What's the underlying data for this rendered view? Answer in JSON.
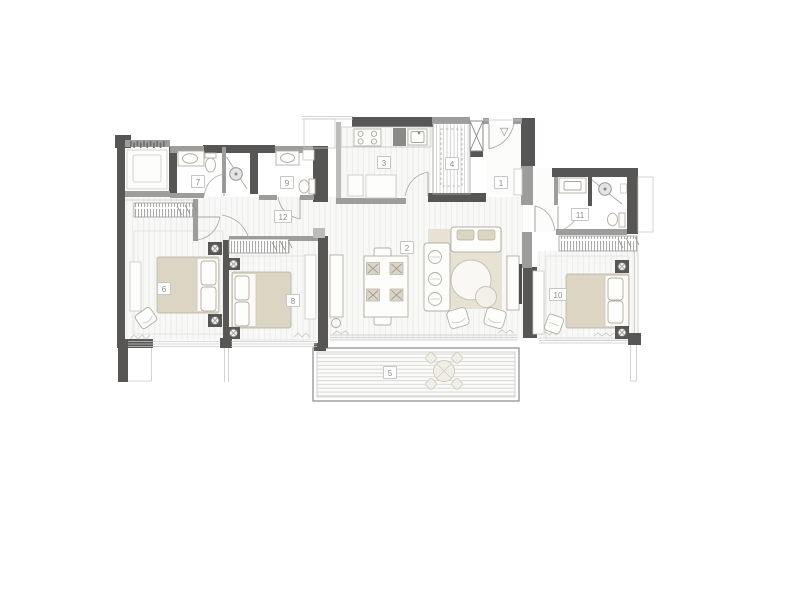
{
  "plan": {
    "entry_marker": "▽",
    "rooms": [
      {
        "label": "1"
      },
      {
        "label": "2"
      },
      {
        "label": "3"
      },
      {
        "label": "4"
      },
      {
        "label": "5"
      },
      {
        "label": "6"
      },
      {
        "label": "7"
      },
      {
        "label": "8"
      },
      {
        "label": "9"
      },
      {
        "label": "10"
      },
      {
        "label": "11"
      },
      {
        "label": "12"
      }
    ]
  },
  "colors": {
    "wall_dark": "#575655",
    "wall_med": "#9d9d9c",
    "wall_light": "#bcbcbb",
    "line": "#a7a7a5",
    "line_light": "#c9c9c7",
    "floor": "#f8f8f6",
    "beige": "#dcd5c3",
    "beige_light": "#e7e2d4",
    "fixture": "#fdfdfc",
    "furn_line": "#b3aea1",
    "label_text": "#8b8b89",
    "label_border": "#c6c6c4",
    "glyph": "#8a8a88"
  }
}
